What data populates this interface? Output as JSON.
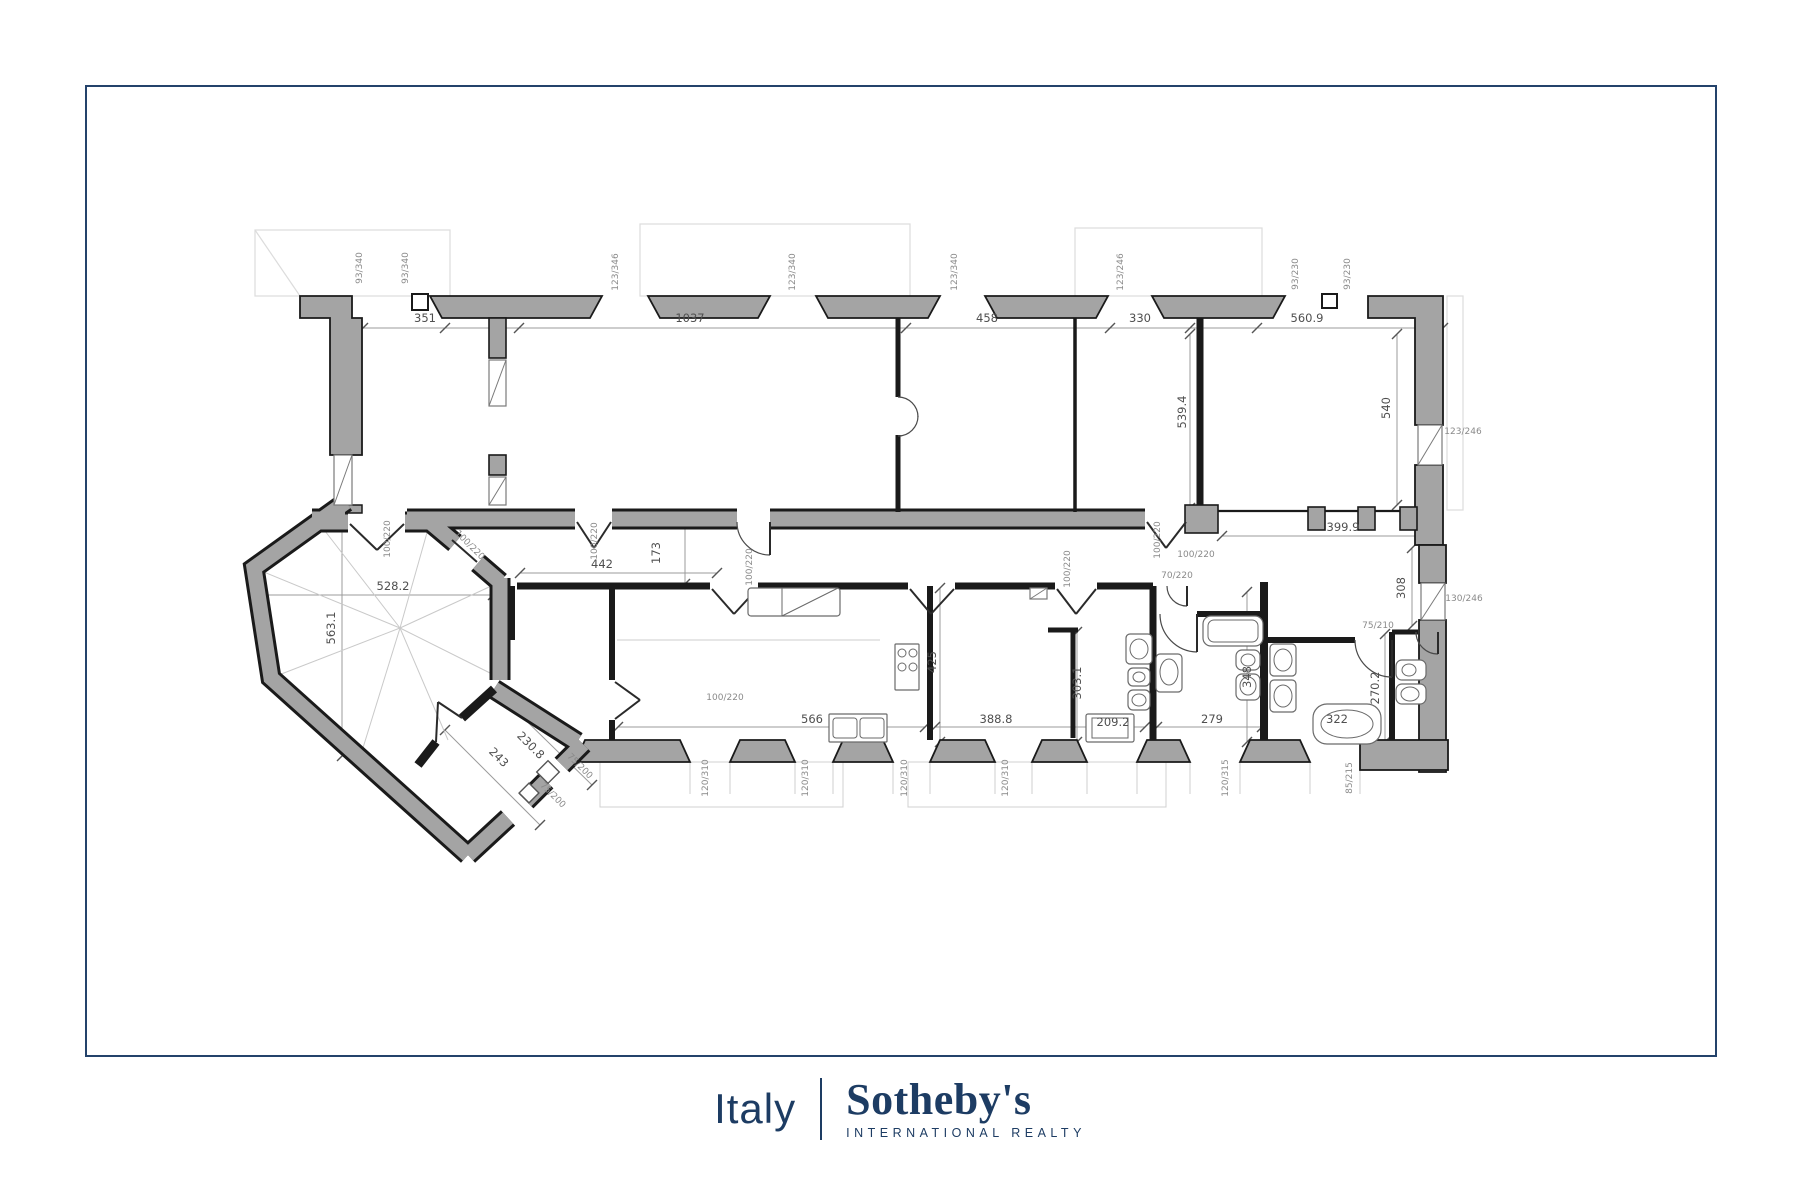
{
  "page": {
    "background": "#ffffff",
    "frame_border_color": "#24436b"
  },
  "branding": {
    "region_label": "Italy",
    "brand_name": "Sotheby's",
    "tagline": "INTERNATIONAL REALTY",
    "text_color": "#1d3c63"
  },
  "floorplan": {
    "colors": {
      "wall_fill": "#a4a4a4",
      "wall_outline": "#1a1a1a",
      "dimension": "#8a8a8a",
      "dimension_dark": "#4f4f4f",
      "fixture": "#6a6a6a",
      "guide": "#c9c9c9"
    },
    "dimension_labels": [
      {
        "t": "93/340",
        "x": 362,
        "y": 268,
        "r": -90,
        "s": 1
      },
      {
        "t": "93/340",
        "x": 408,
        "y": 268,
        "r": -90,
        "s": 1
      },
      {
        "t": "123/346",
        "x": 618,
        "y": 272,
        "r": -90,
        "s": 1
      },
      {
        "t": "123/340",
        "x": 795,
        "y": 272,
        "r": -90,
        "s": 1
      },
      {
        "t": "123/340",
        "x": 957,
        "y": 272,
        "r": -90,
        "s": 1
      },
      {
        "t": "123/246",
        "x": 1123,
        "y": 272,
        "r": -90,
        "s": 1
      },
      {
        "t": "93/230",
        "x": 1298,
        "y": 274,
        "r": -90,
        "s": 1
      },
      {
        "t": "93/230",
        "x": 1350,
        "y": 274,
        "r": -90,
        "s": 1
      },
      {
        "t": "351",
        "x": 425,
        "y": 322,
        "r": 0,
        "s": 0
      },
      {
        "t": "1037",
        "x": 690,
        "y": 322,
        "r": 0,
        "s": 0
      },
      {
        "t": "458",
        "x": 987,
        "y": 322,
        "r": 0,
        "s": 0
      },
      {
        "t": "330",
        "x": 1140,
        "y": 322,
        "r": 0,
        "s": 0
      },
      {
        "t": "560.9",
        "x": 1307,
        "y": 322,
        "r": 0,
        "s": 0
      },
      {
        "t": "539.4",
        "x": 1186,
        "y": 412,
        "r": -90,
        "s": 0
      },
      {
        "t": "540",
        "x": 1390,
        "y": 408,
        "r": -90,
        "s": 0
      },
      {
        "t": "123/246",
        "x": 1463,
        "y": 434,
        "r": 0,
        "s": 1
      },
      {
        "t": "399.9",
        "x": 1343,
        "y": 531,
        "r": 0,
        "s": 0
      },
      {
        "t": "308",
        "x": 1405,
        "y": 588,
        "r": -90,
        "s": 0
      },
      {
        "t": "130/246",
        "x": 1464,
        "y": 601,
        "r": 0,
        "s": 1
      },
      {
        "t": "75/210",
        "x": 1378,
        "y": 628,
        "r": 0,
        "s": 1
      },
      {
        "t": "270.2",
        "x": 1379,
        "y": 688,
        "r": -90,
        "s": 0
      },
      {
        "t": "100/220",
        "x": 390,
        "y": 539,
        "r": -90,
        "s": 1
      },
      {
        "t": "100/220",
        "x": 468,
        "y": 547,
        "r": 45,
        "s": 1
      },
      {
        "t": "100/220",
        "x": 597,
        "y": 541,
        "r": -90,
        "s": 1
      },
      {
        "t": "100/220",
        "x": 752,
        "y": 567,
        "r": -90,
        "s": 1
      },
      {
        "t": "173",
        "x": 660,
        "y": 553,
        "r": -90,
        "s": 0
      },
      {
        "t": "442",
        "x": 602,
        "y": 568,
        "r": 0,
        "s": 0
      },
      {
        "t": "100/220",
        "x": 1070,
        "y": 569,
        "r": -90,
        "s": 1
      },
      {
        "t": "100/220",
        "x": 1160,
        "y": 540,
        "r": -90,
        "s": 1
      },
      {
        "t": "100/220",
        "x": 1196,
        "y": 557,
        "r": 0,
        "s": 1
      },
      {
        "t": "70/220",
        "x": 1177,
        "y": 578,
        "r": 0,
        "s": 1
      },
      {
        "t": "528.2",
        "x": 393,
        "y": 590,
        "r": 0,
        "s": 0
      },
      {
        "t": "563.1",
        "x": 335,
        "y": 628,
        "r": -90,
        "s": 0
      },
      {
        "t": "243",
        "x": 496,
        "y": 760,
        "r": 45,
        "s": 0
      },
      {
        "t": "230.8",
        "x": 528,
        "y": 748,
        "r": 45,
        "s": 0
      },
      {
        "t": "75/200",
        "x": 578,
        "y": 768,
        "r": 45,
        "s": 1
      },
      {
        "t": "75/200",
        "x": 551,
        "y": 797,
        "r": 45,
        "s": 1
      },
      {
        "t": "100/220",
        "x": 725,
        "y": 700,
        "r": 0,
        "s": 1
      },
      {
        "t": "566",
        "x": 812,
        "y": 723,
        "r": 0,
        "s": 0
      },
      {
        "t": "425",
        "x": 936,
        "y": 662,
        "r": -90,
        "s": 0
      },
      {
        "t": "388.8",
        "x": 996,
        "y": 723,
        "r": 0,
        "s": 0
      },
      {
        "t": "303.1",
        "x": 1081,
        "y": 683,
        "r": -90,
        "s": 0
      },
      {
        "t": "209.2",
        "x": 1113,
        "y": 726,
        "r": 0,
        "s": 0
      },
      {
        "t": "348",
        "x": 1251,
        "y": 677,
        "r": -90,
        "s": 0
      },
      {
        "t": "279",
        "x": 1212,
        "y": 723,
        "r": 0,
        "s": 0
      },
      {
        "t": "322",
        "x": 1337,
        "y": 723,
        "r": 0,
        "s": 0
      },
      {
        "t": "120/310",
        "x": 708,
        "y": 778,
        "r": -90,
        "s": 1
      },
      {
        "t": "120/310",
        "x": 808,
        "y": 778,
        "r": -90,
        "s": 1
      },
      {
        "t": "120/310",
        "x": 907,
        "y": 778,
        "r": -90,
        "s": 1
      },
      {
        "t": "120/310",
        "x": 1008,
        "y": 778,
        "r": -90,
        "s": 1
      },
      {
        "t": "120/315",
        "x": 1228,
        "y": 778,
        "r": -90,
        "s": 1
      },
      {
        "t": "85/215",
        "x": 1352,
        "y": 778,
        "r": -90,
        "s": 1
      }
    ]
  }
}
